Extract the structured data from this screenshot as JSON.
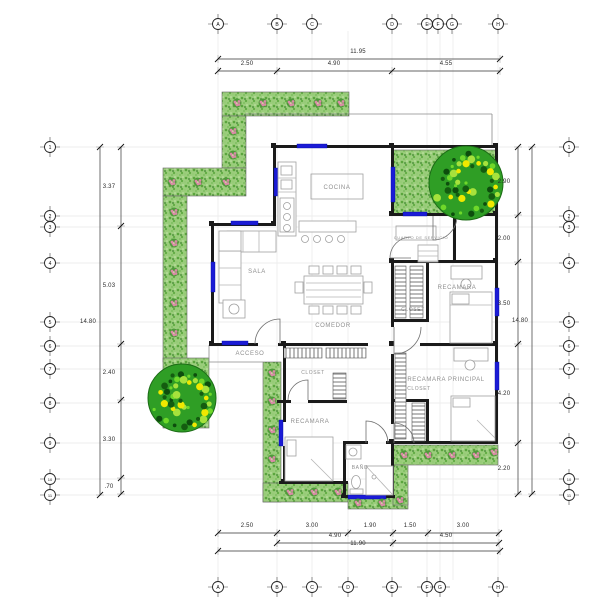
{
  "drawing_title": "floor-plan",
  "colors": {
    "wall": "#1a1a1a",
    "window": "#1b1bd6",
    "furniture": "#a0a0a0",
    "room_label": "#8f8f8f",
    "dim_text": "#2b2b2b",
    "dim_line": "#333333",
    "faint_grid": "#e8e8e8",
    "thin_line": "#8a8a8a",
    "garden_base": "#9bcd7c",
    "garden_dot": "#5aa53d",
    "tree_dark": "#2f9e25",
    "tree_light": "#6fd82a",
    "tree_yellow": "#f0e800",
    "flower_pink": "#d98ca6"
  },
  "grid_bubbles": {
    "top": {
      "cy": 24,
      "items": [
        [
          "A",
          218
        ],
        [
          "B",
          277
        ],
        [
          "C",
          312
        ],
        [
          "D",
          392
        ],
        [
          "E",
          427
        ],
        [
          "F",
          438
        ],
        [
          "G",
          452
        ],
        [
          "H",
          498
        ]
      ]
    },
    "bottom": {
      "cy": 587,
      "items": [
        [
          "A",
          218
        ],
        [
          "B",
          277
        ],
        [
          "C",
          312
        ],
        [
          "D",
          348
        ],
        [
          "E",
          392
        ],
        [
          "F",
          427
        ],
        [
          "G",
          440
        ],
        [
          "H",
          498
        ]
      ]
    },
    "left": {
      "cx": 50,
      "items": [
        [
          "1",
          147
        ],
        [
          "2",
          216
        ],
        [
          "3",
          227
        ],
        [
          "4",
          263
        ],
        [
          "5",
          322
        ],
        [
          "6",
          346
        ],
        [
          "7",
          369
        ],
        [
          "8",
          403
        ],
        [
          "9",
          443
        ],
        [
          "10",
          479
        ],
        [
          "11",
          495
        ]
      ]
    },
    "right": {
      "cx": 569,
      "items": [
        [
          "1",
          147
        ],
        [
          "2",
          216
        ],
        [
          "3",
          227
        ],
        [
          "4",
          263
        ],
        [
          "5",
          322
        ],
        [
          "6",
          346
        ],
        [
          "7",
          369
        ],
        [
          "8",
          403
        ],
        [
          "9",
          443
        ],
        [
          "10",
          479
        ],
        [
          "11",
          495
        ]
      ]
    }
  },
  "faint_grid": {
    "vx": [
      218,
      277,
      312,
      348,
      392,
      427,
      440,
      453,
      498
    ],
    "vy1": 31,
    "vy2": 580,
    "hy": [
      147,
      216,
      227,
      263,
      322,
      346,
      369,
      403,
      443,
      479,
      495
    ],
    "hx1": 57,
    "hx2": 562
  },
  "dimensions": {
    "horizontal": [
      {
        "y": 59,
        "x1": 218,
        "x2": 500,
        "ticks": [
          218,
          500
        ],
        "ly": 53,
        "labels": [
          {
            "t": "11.95",
            "x": 358
          }
        ]
      },
      {
        "y": 71,
        "x1": 218,
        "x2": 500,
        "ticks": [
          218,
          277,
          392,
          500
        ],
        "ly": 65,
        "labels": [
          {
            "t": "2.50",
            "x": 247
          },
          {
            "t": "4.90",
            "x": 334
          },
          {
            "t": "4.55",
            "x": 446
          }
        ]
      },
      {
        "y": 533,
        "x1": 218,
        "x2": 499,
        "ticks": [
          218,
          277,
          348,
          393,
          428,
          499
        ],
        "ly": 527,
        "labels": [
          {
            "t": "2.50",
            "x": 247
          },
          {
            "t": "3.00",
            "x": 312
          },
          {
            "t": "1.90",
            "x": 370
          },
          {
            "t": "1.50",
            "x": 410
          },
          {
            "t": "3.00",
            "x": 463
          }
        ]
      },
      {
        "y": 543,
        "x1": 277,
        "x2": 499,
        "ticks": [
          277,
          393,
          499
        ],
        "ly": 537,
        "labels": [
          {
            "t": "4.90",
            "x": 335
          },
          {
            "t": "4.50",
            "x": 446
          }
        ]
      },
      {
        "y": 551,
        "x1": 218,
        "x2": 500,
        "ticks": [
          218,
          500
        ],
        "ly": 545,
        "labels": [
          {
            "t": "11.90",
            "x": 358
          }
        ]
      }
    ],
    "vertical": [
      {
        "x": 100,
        "y1": 147,
        "y2": 495,
        "ticks": [
          147,
          495
        ],
        "lx": 88,
        "labels": [
          {
            "t": "14.80",
            "y": 321
          }
        ]
      },
      {
        "x": 121,
        "y1": 147,
        "y2": 494,
        "ticks": [
          147,
          226,
          344,
          400,
          478,
          494
        ],
        "lx": 109,
        "labels": [
          {
            "t": "3.37",
            "y": 186
          },
          {
            "t": "5.03",
            "y": 285
          },
          {
            "t": "2.40",
            "y": 372
          },
          {
            "t": "3.30",
            "y": 439
          },
          {
            "t": ".70",
            "y": 486
          }
        ]
      },
      {
        "x": 518,
        "y1": 147,
        "y2": 494,
        "ticks": [
          147,
          215,
          262,
          344,
          443,
          494
        ],
        "lx": 504,
        "labels": [
          {
            "t": "2.90",
            "y": 181
          },
          {
            "t": "2.00",
            "y": 238
          },
          {
            "t": "3.50",
            "y": 303
          },
          {
            "t": "4.20",
            "y": 393
          },
          {
            "t": "2.20",
            "y": 468
          }
        ]
      },
      {
        "x": 532,
        "y1": 147,
        "y2": 494,
        "ticks": [
          147,
          494
        ],
        "lx": 520,
        "labels": [
          {
            "t": "14.80",
            "y": 320
          }
        ]
      }
    ]
  },
  "plan": {
    "gardens": [
      [
        222,
        92,
        127,
        24
      ],
      [
        222,
        116,
        24,
        52
      ],
      [
        163,
        168,
        83,
        28
      ],
      [
        163,
        196,
        24,
        166
      ],
      [
        163,
        358,
        46,
        70
      ],
      [
        393,
        150,
        104,
        65
      ],
      [
        263,
        362,
        18,
        140
      ],
      [
        263,
        483,
        85,
        19
      ],
      [
        348,
        497,
        60,
        12
      ],
      [
        393,
        445,
        105,
        20
      ],
      [
        393,
        465,
        15,
        40
      ]
    ],
    "thin_lines": [
      [
        245,
        114,
        492,
        114
      ],
      [
        492,
        114,
        492,
        145
      ],
      [
        209,
        345,
        209,
        362
      ],
      [
        209,
        362,
        263,
        362
      ]
    ],
    "walls": [
      [
        275,
        145,
        222,
        3
      ],
      [
        393,
        213,
        104,
        3
      ],
      [
        213,
        223,
        63,
        3
      ],
      [
        213,
        343,
        45,
        3
      ],
      [
        278,
        343,
        90,
        3
      ],
      [
        420,
        343,
        77,
        3
      ],
      [
        393,
        260,
        104,
        3
      ],
      [
        393,
        441,
        104,
        3
      ],
      [
        279,
        481,
        69,
        3
      ],
      [
        345,
        495,
        50,
        3
      ],
      [
        345,
        441,
        23,
        3
      ],
      [
        386,
        441,
        9,
        3
      ],
      [
        277,
        400,
        14,
        3
      ],
      [
        308,
        400,
        39,
        3
      ],
      [
        393,
        319,
        36,
        3
      ],
      [
        393,
        399,
        36,
        3
      ],
      [
        273,
        145,
        3,
        81
      ],
      [
        211,
        223,
        3,
        123
      ],
      [
        391,
        145,
        3,
        71
      ],
      [
        495,
        145,
        3,
        299
      ],
      [
        391,
        260,
        3,
        67
      ],
      [
        391,
        354,
        3,
        70
      ],
      [
        391,
        443,
        3,
        54
      ],
      [
        283,
        345,
        3,
        77
      ],
      [
        283,
        446,
        3,
        38
      ],
      [
        343,
        441,
        3,
        56
      ],
      [
        426,
        260,
        3,
        62
      ],
      [
        426,
        399,
        3,
        45
      ],
      [
        453,
        215,
        3,
        47
      ]
    ],
    "columns": [
      [
        272,
        144
      ],
      [
        390,
        144
      ],
      [
        494,
        144
      ],
      [
        390,
        212
      ],
      [
        494,
        212
      ],
      [
        210,
        222
      ],
      [
        272,
        222
      ],
      [
        210,
        342
      ],
      [
        282,
        342
      ],
      [
        390,
        259
      ],
      [
        494,
        259
      ],
      [
        390,
        342
      ],
      [
        494,
        342
      ],
      [
        390,
        440
      ],
      [
        494,
        440
      ],
      [
        282,
        480
      ],
      [
        342,
        494
      ],
      [
        390,
        494
      ]
    ],
    "windows": [
      [
        297,
        144,
        30,
        4
      ],
      [
        403,
        212,
        24,
        4
      ],
      [
        274,
        168,
        4,
        28
      ],
      [
        391,
        167,
        4,
        35
      ],
      [
        231,
        221,
        27,
        4
      ],
      [
        211,
        262,
        4,
        30
      ],
      [
        222,
        341,
        26,
        4
      ],
      [
        495,
        288,
        4,
        28
      ],
      [
        495,
        362,
        4,
        28
      ],
      [
        279,
        420,
        4,
        26
      ],
      [
        348,
        495,
        38,
        4
      ]
    ],
    "hatches": {
      "v": [
        [
          284,
          348,
          38,
          10
        ],
        [
          326,
          348,
          40,
          10
        ]
      ],
      "h": [
        [
          333,
          373,
          13,
          26
        ],
        [
          395,
          266,
          11,
          52
        ],
        [
          410,
          266,
          13,
          52
        ],
        [
          395,
          353,
          11,
          86
        ],
        [
          412,
          403,
          13,
          38
        ]
      ]
    },
    "furniture": {
      "frects": [
        [
          227,
          231,
          49,
          21
        ],
        [
          219,
          251,
          22,
          52
        ],
        [
          219,
          231,
          22,
          20
        ],
        [
          223,
          300,
          22,
          18
        ],
        [
          278,
          162,
          18,
          74
        ],
        [
          281,
          166,
          11,
          9
        ],
        [
          281,
          180,
          11,
          9
        ],
        [
          280,
          198,
          14,
          34
        ],
        [
          299,
          221,
          57,
          11
        ],
        [
          304,
          276,
          59,
          28
        ],
        [
          309,
          266,
          10,
          8
        ],
        [
          323,
          266,
          10,
          8
        ],
        [
          337,
          266,
          10,
          8
        ],
        [
          351,
          266,
          10,
          8
        ],
        [
          309,
          306,
          10,
          8
        ],
        [
          323,
          306,
          10,
          8
        ],
        [
          337,
          306,
          10,
          8
        ],
        [
          351,
          306,
          10,
          8
        ],
        [
          295,
          282,
          8,
          11
        ],
        [
          364,
          282,
          8,
          11
        ],
        [
          450,
          292,
          42,
          51
        ],
        [
          452,
          294,
          17,
          10
        ],
        [
          451,
          266,
          31,
          13
        ],
        [
          451,
          396,
          44,
          45
        ],
        [
          453,
          398,
          17,
          9
        ],
        [
          454,
          348,
          34,
          13
        ],
        [
          285,
          437,
          48,
          44
        ],
        [
          287,
          440,
          9,
          16
        ],
        [
          346,
          445,
          15,
          14
        ],
        [
          350,
          489,
          13,
          5
        ],
        [
          366,
          466,
          27,
          29
        ],
        [
          418,
          245,
          20,
          17
        ]
      ],
      "fboxes": [
        [
          311,
          174,
          52,
          25
        ],
        [
          396,
          226,
          40,
          14
        ]
      ],
      "flines": [
        [
          243,
          231,
          243,
          252
        ],
        [
          259,
          231,
          259,
          252
        ],
        [
          219,
          268,
          241,
          268
        ],
        [
          219,
          285,
          241,
          285
        ],
        [
          278,
          178,
          296,
          178
        ],
        [
          278,
          192,
          296,
          192
        ],
        [
          306,
          283,
          361,
          283
        ],
        [
          306,
          290,
          361,
          290
        ],
        [
          306,
          297,
          361,
          297
        ],
        [
          450,
          305,
          492,
          305
        ],
        [
          477,
          420,
          495,
          438
        ],
        [
          311,
          459,
          333,
          481
        ],
        [
          366,
          466,
          393,
          495
        ],
        [
          418,
          251,
          438,
          251
        ],
        [
          418,
          256,
          438,
          256
        ],
        [
          418,
          261,
          438,
          261
        ]
      ],
      "fcircles": [
        [
          234,
          309,
          5
        ],
        [
          305,
          239,
          3.5
        ],
        [
          317,
          239,
          3.5
        ],
        [
          329,
          239,
          3.5
        ],
        [
          341,
          239,
          3.5
        ],
        [
          287,
          206,
          3.5
        ],
        [
          287,
          217,
          3.5
        ],
        [
          287,
          228,
          3.5
        ],
        [
          466,
          284,
          5
        ],
        [
          470,
          365,
          5
        ],
        [
          353,
          452,
          4
        ],
        [
          374,
          477,
          2
        ]
      ],
      "fellipses": [
        [
          356,
          482,
          4.5,
          6.5
        ]
      ]
    },
    "doors": [
      "M280 344 L280 319 A25 25 0 0 0 255 344",
      "M394 327 L394 354 A27 27 0 0 0 421 327",
      "M308 400 L308 380 A20 20 0 0 0 288 400",
      "M366 443 L366 421 A22 22 0 0 1 388 443",
      "M433 216 L433 240 A24 24 0 0 0 457 216",
      "M411 258 L390 258 A21 21 0 0 1 411 237",
      "M394 443 L394 423 A20 20 0 0 1 414 443"
    ],
    "flowers": [
      [
        237,
        103
      ],
      [
        263,
        103
      ],
      [
        291,
        103
      ],
      [
        318,
        103
      ],
      [
        341,
        103
      ],
      [
        233,
        131
      ],
      [
        233,
        155
      ],
      [
        172,
        182
      ],
      [
        198,
        182
      ],
      [
        226,
        182
      ],
      [
        174,
        212
      ],
      [
        174,
        243
      ],
      [
        174,
        272
      ],
      [
        174,
        303
      ],
      [
        174,
        333
      ],
      [
        272,
        373
      ],
      [
        272,
        401
      ],
      [
        272,
        430
      ],
      [
        272,
        459
      ],
      [
        290,
        492
      ],
      [
        314,
        492
      ],
      [
        338,
        492
      ],
      [
        358,
        503
      ],
      [
        382,
        503
      ],
      [
        400,
        500
      ],
      [
        404,
        455
      ],
      [
        428,
        455
      ],
      [
        452,
        455
      ],
      [
        476,
        455
      ],
      [
        494,
        452
      ]
    ],
    "trees": [
      {
        "cx": 466,
        "cy": 183,
        "r": 37
      },
      {
        "cx": 182,
        "cy": 398,
        "r": 34
      }
    ],
    "rooms": [
      {
        "t": "COCINA",
        "x": 337,
        "y": 189,
        "fs": 6
      },
      {
        "t": "SALA",
        "x": 257,
        "y": 273,
        "fs": 6
      },
      {
        "t": "COMEDOR",
        "x": 333,
        "y": 327,
        "fs": 6
      },
      {
        "t": "ACCESO",
        "x": 250,
        "y": 355,
        "fs": 6
      },
      {
        "t": "CLOSET",
        "x": 313,
        "y": 374,
        "fs": 5
      },
      {
        "t": "RECAMARA",
        "x": 310,
        "y": 423,
        "fs": 6
      },
      {
        "t": "BAÑO",
        "x": 360,
        "y": 469,
        "fs": 5
      },
      {
        "t": "CUARTO DE SERVICIO",
        "x": 421,
        "y": 239,
        "fs": 4
      },
      {
        "t": "RECAMARA",
        "x": 457,
        "y": 289,
        "fs": 6
      },
      {
        "t": "CLOSET",
        "x": 413,
        "y": 311,
        "fs": 5
      },
      {
        "t": "RECAMARA PRINCIPAL",
        "x": 446,
        "y": 381,
        "fs": 6
      },
      {
        "t": "CLOSET",
        "x": 419,
        "y": 390,
        "fs": 5
      }
    ]
  }
}
